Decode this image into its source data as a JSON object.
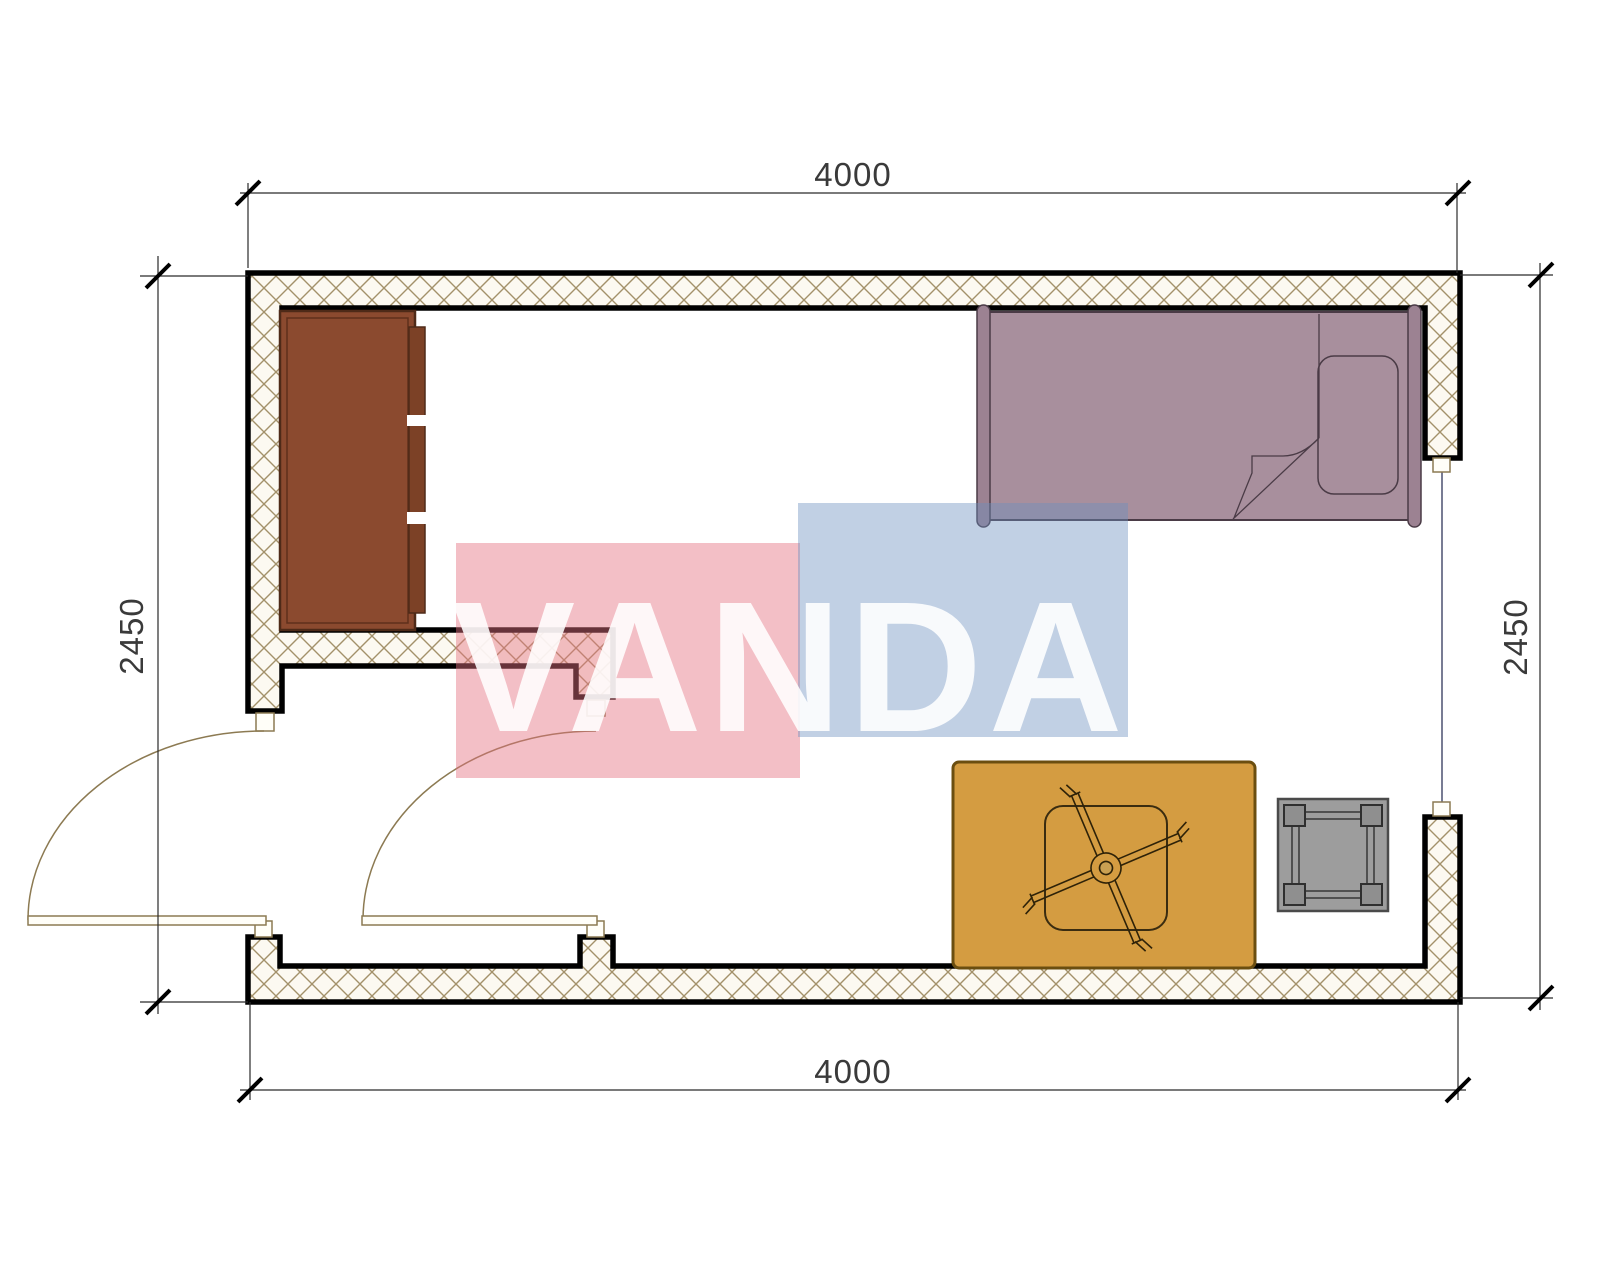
{
  "watermark": {
    "text": "VANDA",
    "red_block_color": "#e57080",
    "blue_block_color": "#6c8ebe",
    "text_color": "#ffffff"
  },
  "dimensions": {
    "top": "4000",
    "bottom": "4000",
    "left": "2450",
    "right": "2450"
  },
  "plan": {
    "wall_line_color": "#000000",
    "wall_hatch_line_color": "#a3916a",
    "wall_fill_color": "#fcf9f1",
    "door_swing_color": "#8c7a52",
    "window_line_color": "#3f4566",
    "doors_count": 2,
    "windows_count": 1,
    "furniture": [
      {
        "name": "wardrobe",
        "color": "#8b4a2f"
      },
      {
        "name": "bed",
        "color": "#a88f9d"
      },
      {
        "name": "pillow",
        "color": "#a88f9d"
      },
      {
        "name": "rug",
        "color": "#d49c41"
      },
      {
        "name": "table-with-fan",
        "color": "#d49c41"
      },
      {
        "name": "stool",
        "color": "#9d9d9d"
      }
    ]
  }
}
